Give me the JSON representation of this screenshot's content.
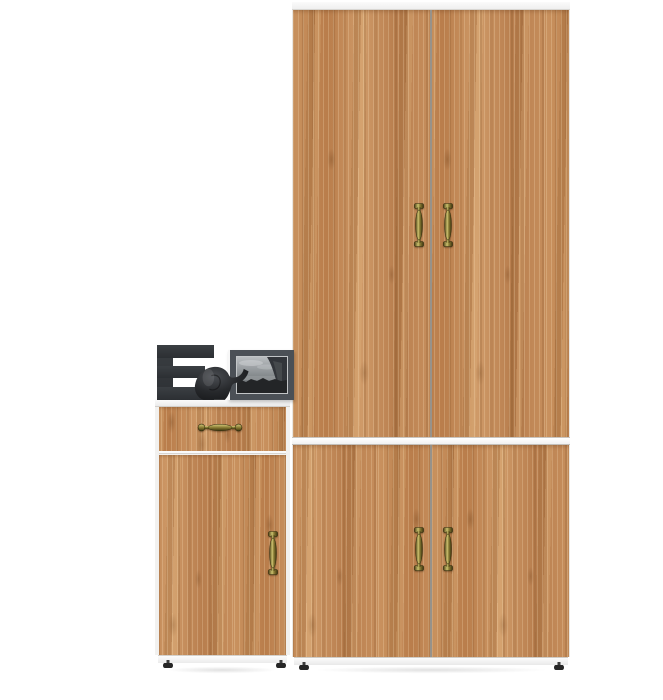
{
  "scene": {
    "label": "Product photo of an oak hallway furniture set on a white background",
    "background": "#ffffff"
  },
  "colors": {
    "wood_base": "#c0885a",
    "wood_highlight": "#dcb384",
    "wood_shadow": "#8d6037",
    "trim_white": "#f6f6f6",
    "handle_brass": "#8a7c35",
    "decor_charcoal": "#33373b",
    "door_gap_gray": "#97928a"
  },
  "wardrobe": {
    "label": "Tall two-section oak wardrobe with white top, middle band and plinth",
    "upper_door_count": 2,
    "lower_door_count": 2,
    "handle_style": "antique brass vertical pulls"
  },
  "cabinet": {
    "label": "Small oak cabinet with one drawer and one door",
    "drawer_count": 1,
    "door_count": 1,
    "drawer_handle_style": "antique brass bow pull",
    "door_handle_style": "antique brass vertical pull"
  },
  "decor": {
    "letter": "E",
    "letter_label": "Charcoal block letter E ornament",
    "figurine_label": "Black elephant figurine",
    "frame_label": "Dark gray picture frame with black-and-white seascape photo"
  }
}
